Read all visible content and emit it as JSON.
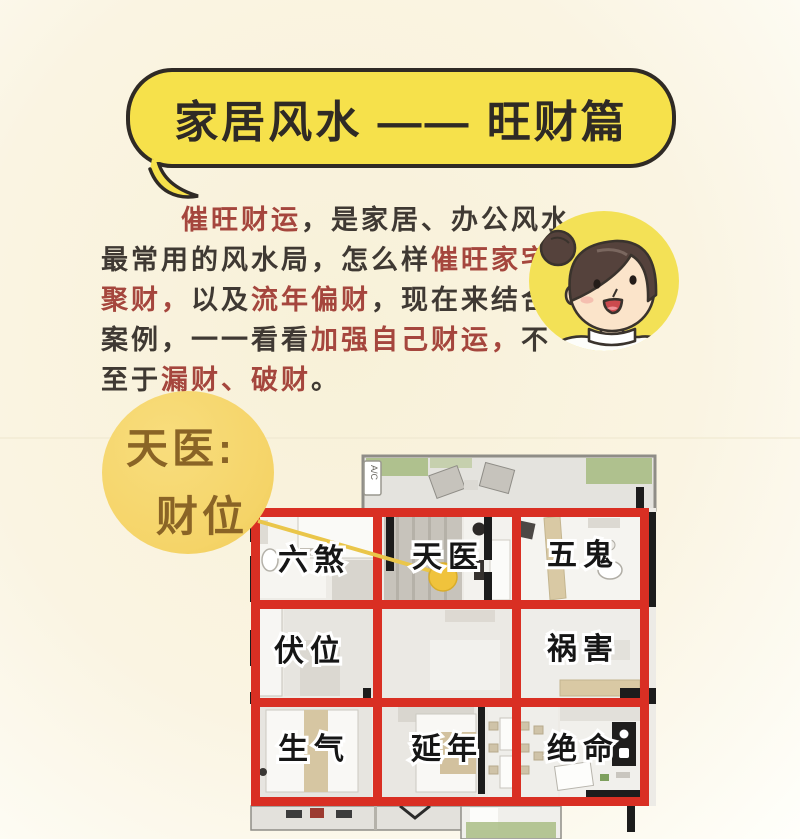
{
  "theme": {
    "bubble_yellow": "#f6e14b",
    "outline_dark": "#2f2a25",
    "ink": "#3f3933",
    "red": "#a5463d",
    "circle_yellow": "#f5d468",
    "circle_brown": "#8a6426",
    "grid_red": "#d92f23",
    "dot_gold": "#f0c33c",
    "avatar_yellow": "#f3e156",
    "wall_black": "#1c1c1c",
    "plan_base": "#edebe6",
    "tan": "#d9c9a4",
    "green": "#a9bd85"
  },
  "header": {
    "title": "家居风水 —— 旺财篇"
  },
  "intro": {
    "lines": [
      {
        "segments": [
          {
            "text": "催旺财运"
          },
          {
            "text": "，是家居、办公风水"
          }
        ]
      },
      {
        "segments": [
          {
            "text": "最常用的风水局，怎么样"
          },
          {
            "text": "催旺家宅"
          }
        ]
      },
      {
        "segments": [
          {
            "text": "聚财，"
          },
          {
            "text": "以及"
          },
          {
            "text": "流年偏财"
          },
          {
            "text": "，现在来结合"
          }
        ]
      },
      {
        "segments": [
          {
            "text": "案例，一一看看"
          },
          {
            "text": "加强自己财运，"
          },
          {
            "text": "不"
          }
        ]
      },
      {
        "segments": [
          {
            "text": "至于"
          },
          {
            "text": "漏财、破财"
          },
          {
            "text": "。"
          }
        ]
      }
    ]
  },
  "callout": {
    "line1": "天医:",
    "line2": "财位"
  },
  "floorplan": {
    "balcony_tag": "A/C",
    "cells": [
      {
        "label": "六煞"
      },
      {
        "label": "天医"
      },
      {
        "label": "五鬼"
      },
      {
        "label": "伏位"
      },
      {
        "label": "祸害"
      },
      {
        "label": "生气"
      },
      {
        "label": "延年"
      },
      {
        "label": "绝命"
      }
    ]
  },
  "icons": {
    "avatar": "woman-bun-avatar",
    "wealth_marker": "gold-dot"
  }
}
